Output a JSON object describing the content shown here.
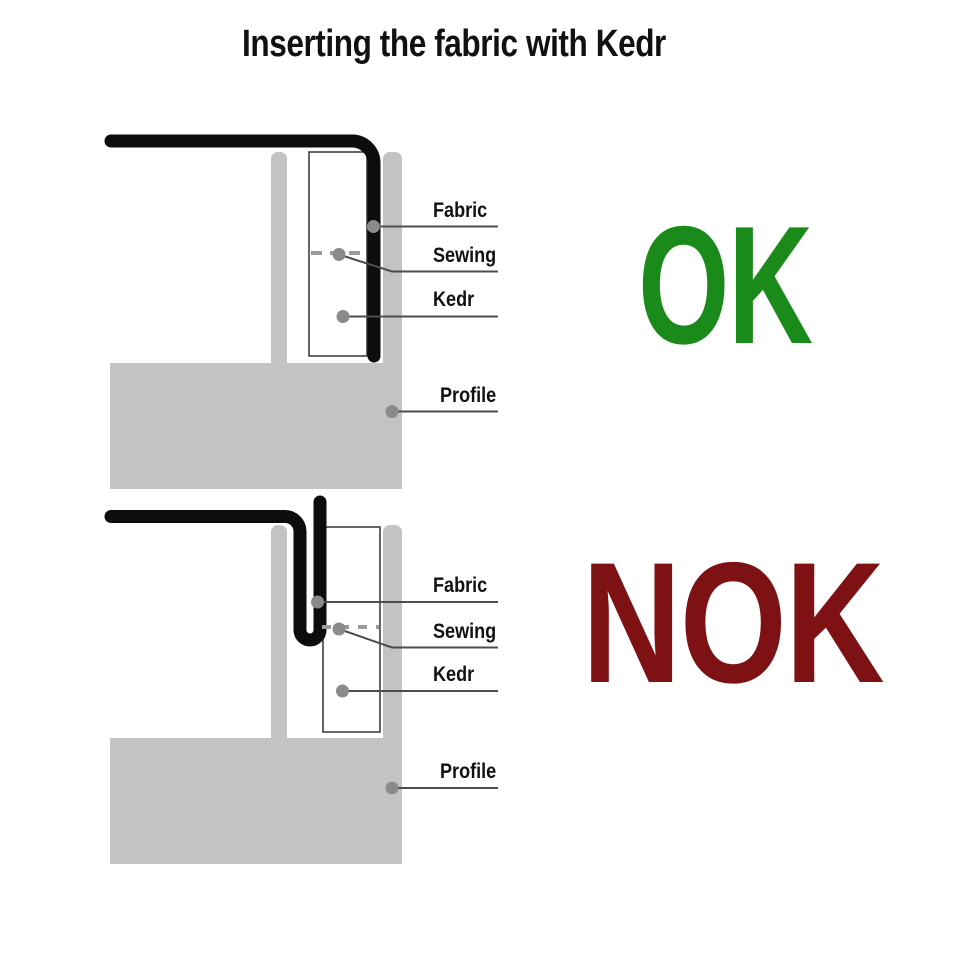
{
  "title": "Inserting the fabric with Kedr",
  "verdicts": {
    "ok": "OK",
    "nok": "NOK"
  },
  "colors": {
    "background": "#ffffff",
    "ok_green": "#1a8a1a",
    "nok_red": "#7d1114",
    "profile_gray": "#c3c3c3",
    "fabric_black": "#0d0d0d",
    "kedr_box_fill": "#ffffff",
    "kedr_box_border": "#333333",
    "leader_line": "#4d4d4d",
    "marker_dot": "#8a8a8a",
    "stitch_dash": "#9a9a9a",
    "text_black": "#111111"
  },
  "diagrams": {
    "ok": {
      "labels": {
        "fabric": "Fabric",
        "sewing": "Sewing",
        "kedr": "Kedr",
        "profile": "Profile"
      }
    },
    "nok": {
      "labels": {
        "fabric": "Fabric",
        "sewing": "Sewing",
        "kedr": "Kedr",
        "profile": "Profile"
      }
    }
  }
}
